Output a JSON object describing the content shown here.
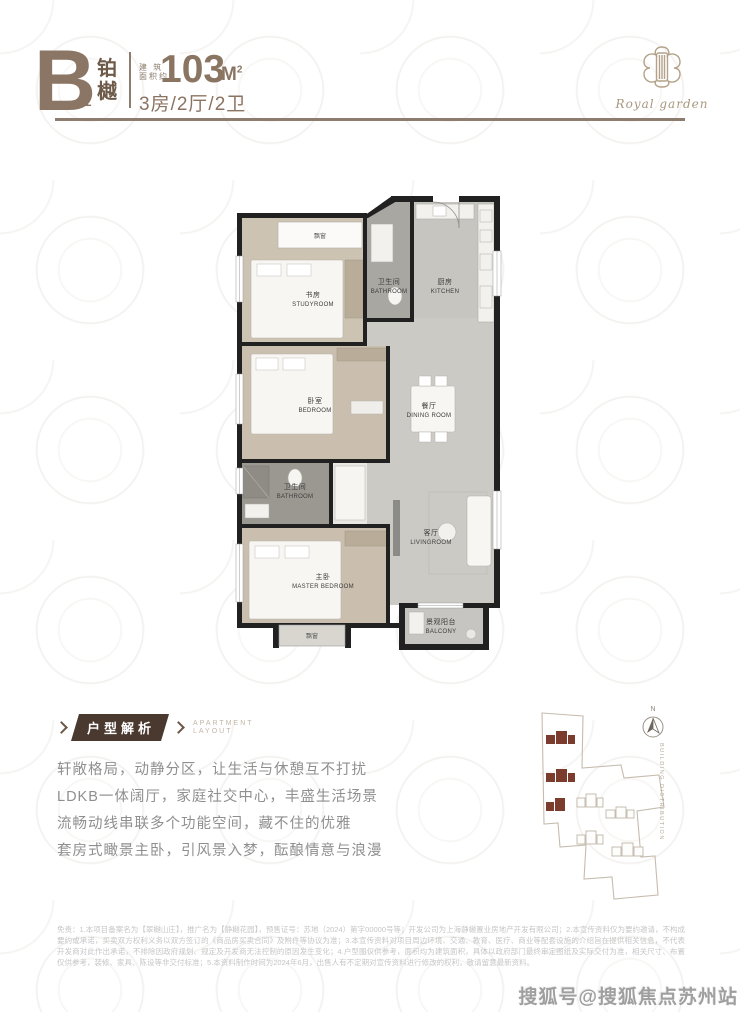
{
  "header": {
    "unit_letter": "B",
    "unit_sub": "1",
    "unit_name_top": "铂",
    "unit_name_bottom": "樾",
    "area_label_line1": "建 筑",
    "area_label_line2": "面积约",
    "area_value": "103",
    "area_unit": "M",
    "area_unit_sup": "2",
    "layout_spec": "3房/2厅/2卫"
  },
  "logo": {
    "script_text": "Royal garden"
  },
  "floorplan": {
    "rooms": {
      "study": {
        "cn": "书房",
        "en": "STUDYROOM"
      },
      "bath1": {
        "cn": "卫生间",
        "en": "BATHROOM"
      },
      "kitchen": {
        "cn": "厨房",
        "en": "KITCHEN"
      },
      "bedroom": {
        "cn": "卧室",
        "en": "BEDROOM"
      },
      "dining": {
        "cn": "餐厅",
        "en": "DINING ROOM"
      },
      "bath2": {
        "cn": "卫生间",
        "en": "BATHROOM"
      },
      "master": {
        "cn": "主卧",
        "en": "MASTER BEDROOM"
      },
      "living": {
        "cn": "客厅",
        "en": "LIVINGROOM"
      },
      "balcony": {
        "cn": "景观阳台",
        "en": "BALCONY"
      }
    },
    "bay_window_top": "飘窗",
    "bay_window_bottom": "飘窗"
  },
  "analysis": {
    "ribbon_title": "户型解析",
    "subtitle_line1": "APARTMENT",
    "subtitle_line2": "LAYOUT",
    "paragraphs": [
      "轩敞格局，动静分区，让生活与休憩互不打扰",
      "LDKB一体阔厅，家庭社交中心，丰盛生活场景",
      "流畅动线串联多个功能空间，藏不住的优雅",
      "套房式瞰景主卧，引风景入梦，酝酿情意与浪漫"
    ]
  },
  "sitemap": {
    "north_label": "N",
    "vertical_label": "BUILDING DISTRIBUTION"
  },
  "disclaimer": {
    "text": "免责：1.本项目备案名为【翠樾山庄】，推广名为【静樾花园】，预售证号：苏地（2024）第字00000号等；开发公司为上海静樾置业房地产开发有限公司；2.本宣传资料仅为要约邀请，不构成要约或承诺，买卖双方权利义务以双方签订的《商品房买卖合同》及附件等协议为准；3.本宣传资料对项目周边环境、交通、教育、医疗、商业等配套设施的介绍旨在提供相关信息，不代表开发商对此作出承诺，不排除因政府规划、规定及开发商无法控制的原因发生变化；4.户型图仅供参考，面积均为建筑面积，具体以政府部门最终审定图纸及实际交付为准，相关尺寸、布置仅供参考，装修、家具、陈设等非交付标准；5.本资料制作时间为2024年6月，出售人有不定期对宣传资料进行修改的权利，敬请留意最新资料。"
  },
  "watermark": "搜狐号@搜狐焦点苏州站",
  "colors": {
    "brand_brown": "#8b7565",
    "dark_brown": "#4a392e",
    "accent_red": "#7c3c2d"
  }
}
